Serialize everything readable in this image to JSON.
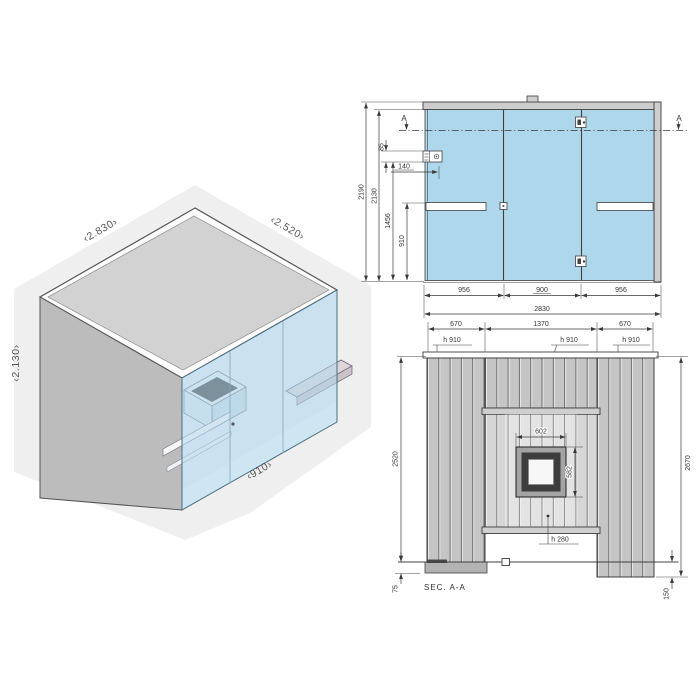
{
  "colors": {
    "glass": "#aed7ec",
    "glass_face": "#b3d8ec",
    "roof": "#d2d2d2",
    "wall": "#bcbcbc",
    "backdrop": "#efefef",
    "panel_dark": "#c5c5c5",
    "panel_light": "#d6d6d6",
    "shelf": "#ded5d9",
    "line": "#3a3a3a",
    "blue_label": "#5aa9d3"
  },
  "isometric": {
    "width_label": "‹2.830›",
    "depth_label": "‹2.520›",
    "height_label": "‹2.130›",
    "door_width_label": "‹910›"
  },
  "plan": {
    "section_marker_left": "A",
    "section_marker_right": "A",
    "dims": {
      "overall_depth": "2190",
      "inner_depth": "2130",
      "bench_offset": "1456",
      "bench_depth": "910",
      "vent_offset": "140",
      "vent_height": "85",
      "panel_left": "956",
      "door_width": "900",
      "panel_right": "956",
      "overall_width": "2830"
    }
  },
  "elevation": {
    "section_title": "SEC. A-A",
    "dims": {
      "left_wall_width": "670",
      "center_width": "1370",
      "right_wall_width": "670",
      "bench_height_left": "h 910",
      "bench_height_center": "h 910",
      "bench_height_right": "h 910",
      "window_width": "602",
      "window_height": "582",
      "lower_bench_height": "h 280",
      "height_left": "2520",
      "height_right": "2670",
      "plinth_height": "75",
      "foot_height": "150"
    }
  }
}
